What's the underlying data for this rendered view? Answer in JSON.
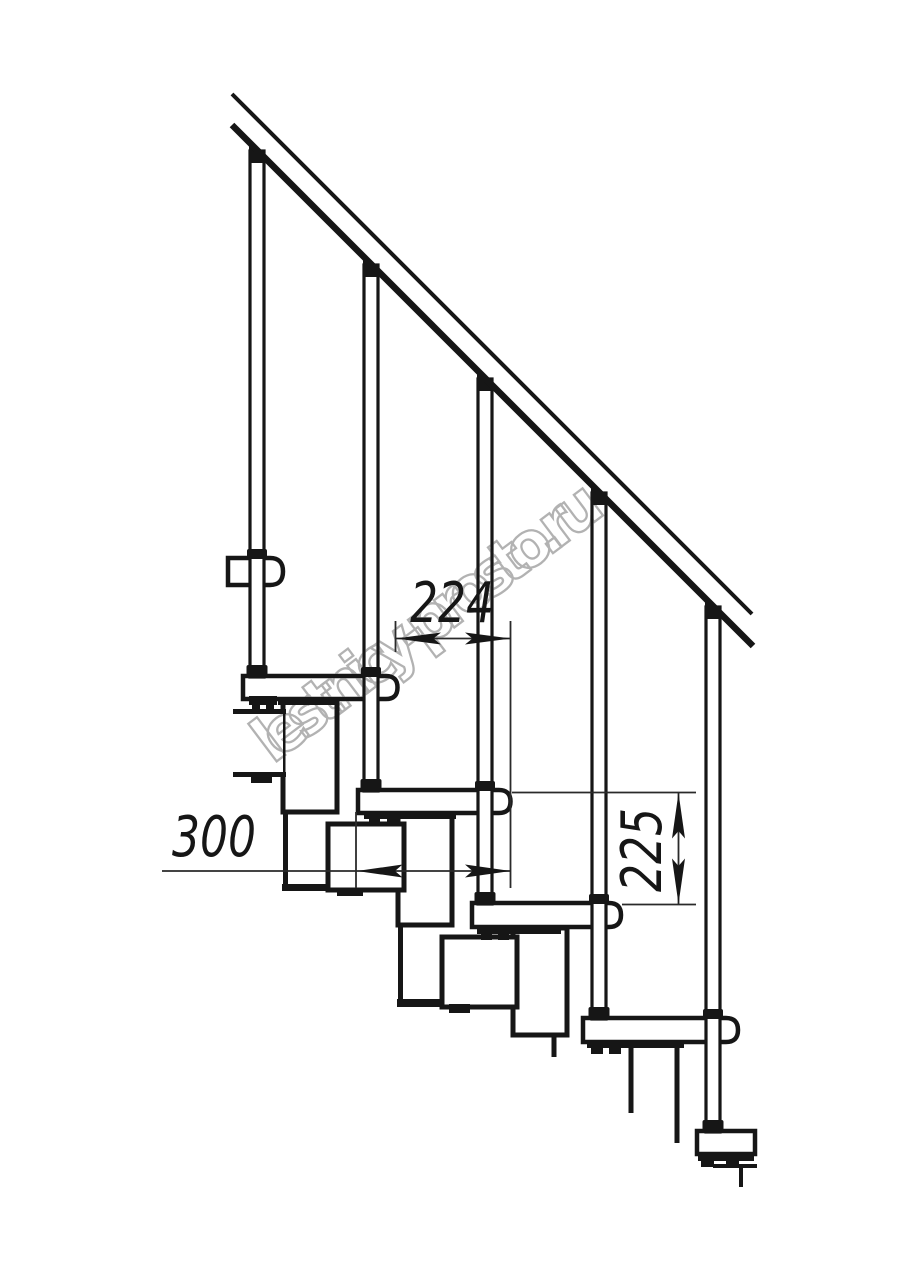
{
  "document": {
    "type": "technical-drawing",
    "subject": "modular staircase side elevation fragment"
  },
  "watermark": {
    "text": "lestnicy-prosto.ru",
    "color": "#a5a5a5"
  },
  "dimensions": {
    "run": {
      "label": "224",
      "meaning": "horizontal step spacing between tread noses"
    },
    "depth": {
      "label": "300",
      "meaning": "tread depth"
    },
    "rise": {
      "label": "225",
      "meaning": "vertical rise between treads"
    }
  },
  "colors": {
    "background": "#ffffff",
    "line": "#161616",
    "dimension_line": "#2a2a2a",
    "watermark": "#a5a5a5"
  },
  "components": {
    "handrail_count": 1,
    "baluster_count": 5,
    "tread_count": 6
  }
}
